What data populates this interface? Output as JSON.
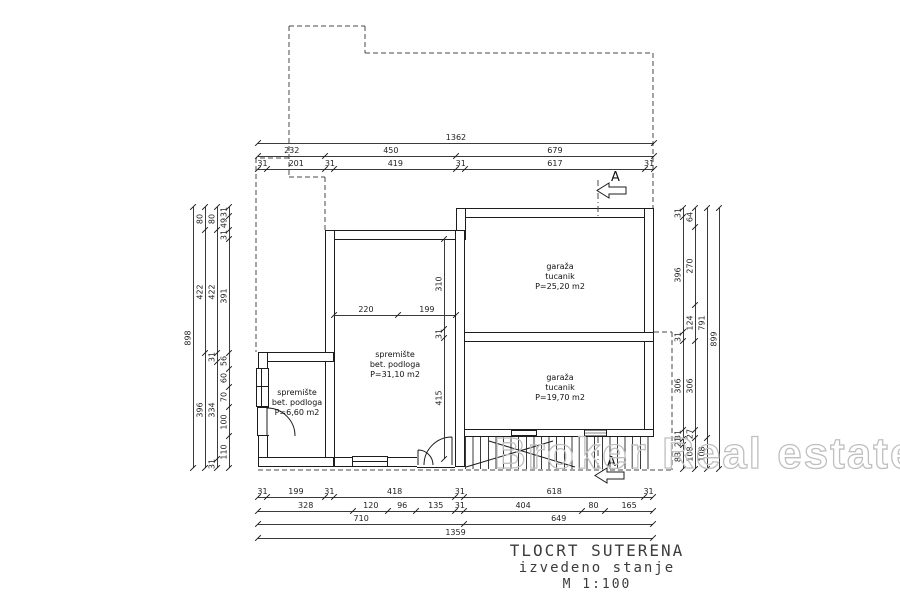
{
  "drawing": {
    "title": "TLOCRT SUTERENA",
    "subtitle": "izvedeno stanje",
    "scale_label": "M 1:100",
    "watermark": "Broker Real estate",
    "section_marker": "A"
  },
  "rooms": [
    {
      "name": "garaža",
      "finish": "tucanik",
      "area": "P=25,20 m2"
    },
    {
      "name": "garaža",
      "finish": "tucanik",
      "area": "P=19,70 m2"
    },
    {
      "name": "spremište",
      "finish": "bet. podloga",
      "area": "P=31,10 m2"
    },
    {
      "name": "spremište",
      "finish": "bet. podloga",
      "area": "P=6,60 m2"
    }
  ],
  "dimensions": {
    "scale_px_per_cm": 0.2907,
    "chains": [
      {
        "id": "t1",
        "side": "top",
        "segments": [
          "1362"
        ]
      },
      {
        "id": "t2",
        "side": "top",
        "segments": [
          "232",
          "450",
          "679"
        ]
      },
      {
        "id": "t3",
        "side": "top",
        "segments": [
          "31",
          "201",
          "31",
          "419",
          "31",
          "617",
          "31"
        ]
      },
      {
        "id": "l1",
        "side": "left",
        "segments": [
          "898"
        ]
      },
      {
        "id": "l2",
        "side": "left",
        "segments": [
          "80",
          "422",
          "396"
        ]
      },
      {
        "id": "l3",
        "side": "left",
        "segments": [
          "80",
          "422",
          "31",
          "334",
          "31"
        ]
      },
      {
        "id": "l4",
        "side": "left",
        "segments": [
          "31",
          "49",
          "31",
          "391",
          "56",
          "60",
          "70",
          "100",
          "110"
        ]
      },
      {
        "id": "r1",
        "side": "right",
        "segments": [
          "31",
          "396",
          "31",
          "306",
          "31",
          "21",
          "83"
        ]
      },
      {
        "id": "r2",
        "side": "right",
        "segments": [
          "64",
          "270",
          "124",
          "306",
          "27",
          "108"
        ]
      },
      {
        "id": "r3",
        "side": "right",
        "segments": [
          "791",
          "108"
        ]
      },
      {
        "id": "r4",
        "side": "right",
        "segments": [
          "899"
        ]
      },
      {
        "id": "b1",
        "side": "bottom",
        "segments": [
          "31",
          "199",
          "31",
          "418",
          "31",
          "618",
          "31"
        ]
      },
      {
        "id": "b2",
        "side": "bottom",
        "segments": [
          "328",
          "120",
          "96",
          "135",
          "31",
          "404",
          "80",
          "165"
        ]
      },
      {
        "id": "b3",
        "side": "bottom",
        "segments": [
          "710",
          "649"
        ]
      },
      {
        "id": "b4",
        "side": "bottom",
        "segments": [
          "1359"
        ]
      },
      {
        "id": "i1",
        "side": "interior",
        "segments": [
          "220",
          "199"
        ]
      },
      {
        "id": "i2",
        "side": "interior",
        "segments": [
          "310",
          "31",
          "415"
        ]
      }
    ]
  }
}
